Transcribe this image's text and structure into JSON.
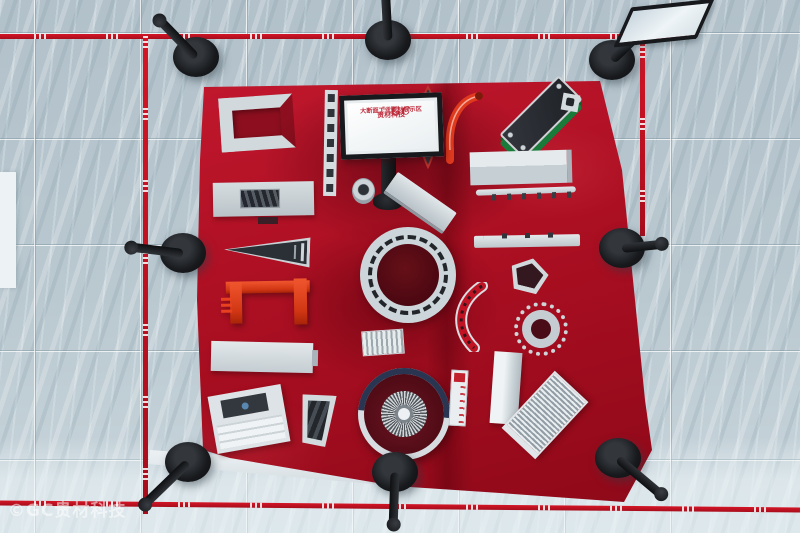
{
  "meta": {
    "scene": "top-down photograph of an aluminium extrusion profile exhibition area",
    "colors": {
      "carpet_red": "#ab0f22",
      "floor_tile": "#bac8d0",
      "tape_red": "#c41020",
      "stanchion_black": "#17191c",
      "ibeam_orange_red": "#e8411f",
      "radiator_green": "#1a7a3a",
      "profile_silver": "#d2d9dd"
    }
  },
  "sign": {
    "logo": "GC",
    "logo_registered": "®",
    "logo_subtext": "贵材铝材",
    "line1": "贵材科技",
    "line2": "大断面工业型材展示区"
  },
  "watermark": {
    "text": "©GC贵材科技"
  },
  "exhibits": [
    "u-channel-profile",
    "ladder-strip-profile",
    "boat-shaped-profile",
    "red-hook-profile",
    "green-radiator-profile",
    "small-square-profile",
    "handle-panel-profile",
    "round-knob-profile",
    "wedge-bar-profile",
    "rail-box-profile",
    "serrated-strip-profile",
    "cone-profile",
    "red-i-beam-profile",
    "large-ring-profile",
    "thin-rail-profile",
    "pentagon-profile",
    "curved-arc-profile",
    "gear-ring-profile",
    "corrugated-panel-profile",
    "long-bar-profile",
    "vertical-bar-profile",
    "stepped-profile",
    "angled-bracket-profile",
    "turbine-housing-profile",
    "ruler-strip-profile",
    "comb-radiator-profile"
  ]
}
